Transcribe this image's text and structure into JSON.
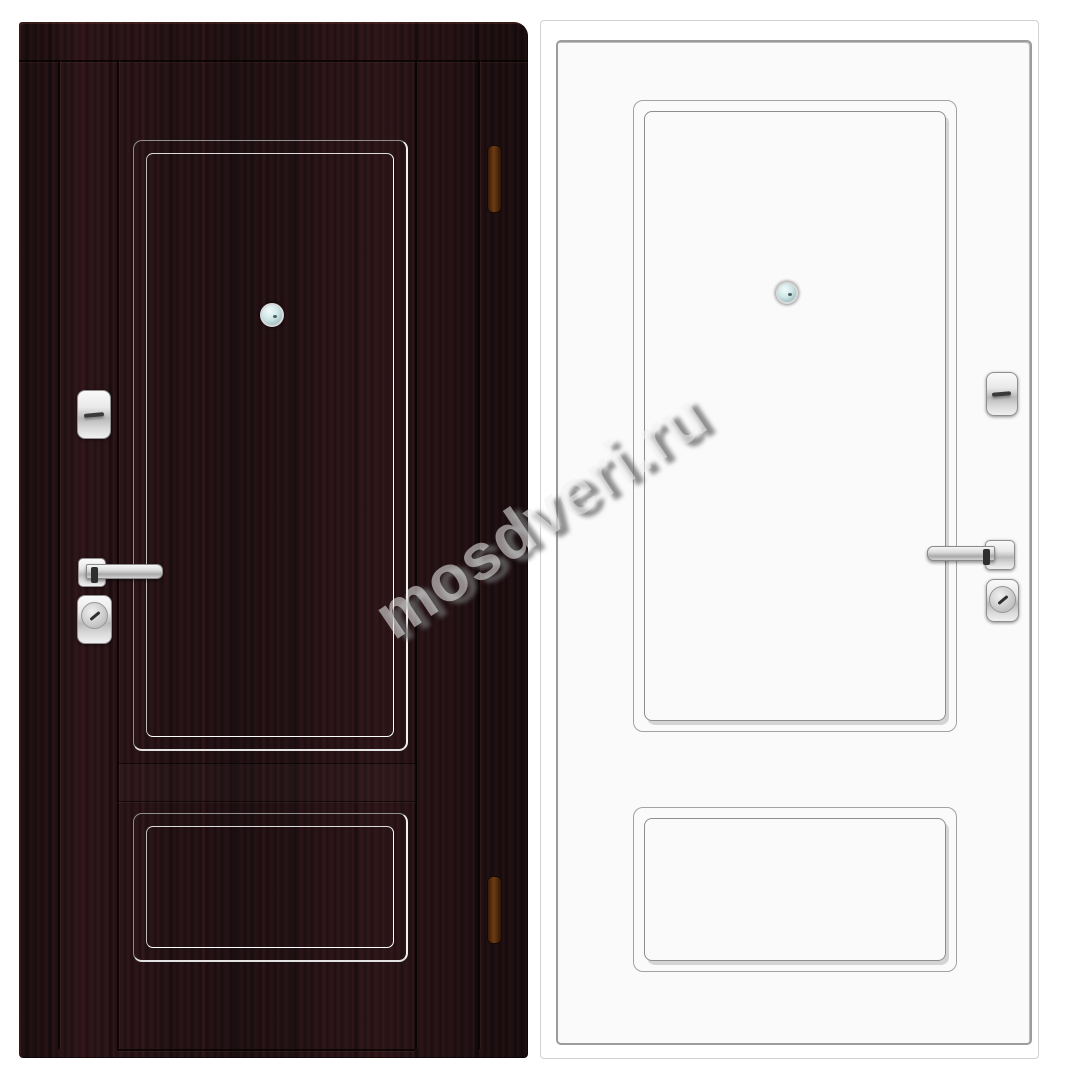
{
  "watermark": {
    "text": "mosdveri.ru"
  },
  "photo": {
    "left_view": "door-front-dark-wenge",
    "right_view": "door-back-white",
    "hardware_items": [
      "peephole",
      "night-latch",
      "lever-handle",
      "cylinder-lock",
      "hinge"
    ]
  },
  "colors": {
    "wenge": "#241317",
    "white_leaf": "#fafafa",
    "outline_gray": "#9c9c9c",
    "chrome": "#d9d9d9",
    "hinge_brown": "#5a2d10",
    "peephole_lens": "#cfe6e7",
    "background": "#ffffff"
  }
}
